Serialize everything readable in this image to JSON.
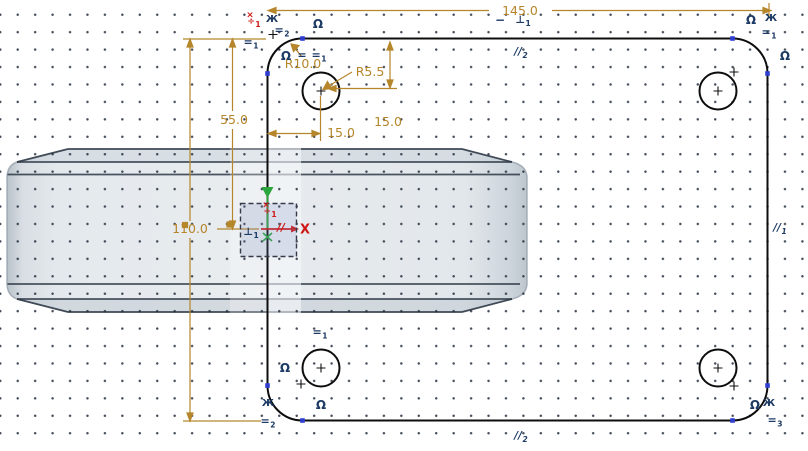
{
  "canvas": {
    "width": 808,
    "height": 451
  },
  "colors": {
    "background": "#ffffff",
    "dim": "#b5862b",
    "con": "#1c3a63",
    "red": "#cf1717",
    "green": "#2aa63c",
    "sketch_line": "#0d0d0d",
    "vertex": "#2e3ed2",
    "part_fill": "#e6eaee",
    "part_edge": "#39424e"
  },
  "grid": {
    "spacing_px": 17.45,
    "style": "dots"
  },
  "sketch": {
    "plate_width": "145.0",
    "plate_height": "110.0",
    "origin_to_top": "55.0",
    "hole_offset_x": "15.0",
    "hole_offset_y": "15.0",
    "hole_radius": "R5.5",
    "corner_radius": "R10.0",
    "x_axis_label": "X"
  },
  "annotations": [
    {
      "n": "dimension-width-label",
      "t": "145.0",
      "x": 520,
      "y": 11,
      "c": "dim",
      "s": 12.5
    },
    {
      "n": "dimension-height-label",
      "t": "110.0",
      "x": 190,
      "y": 229,
      "c": "dim",
      "s": 12.5
    },
    {
      "n": "dimension-half-height-label",
      "t": "55.0",
      "x": 234,
      "y": 120,
      "c": "dim",
      "s": 12.5
    },
    {
      "n": "dimension-hole-x-label",
      "t": "15.0",
      "x": 341,
      "y": 133,
      "c": "dim",
      "s": 12.5
    },
    {
      "n": "dimension-hole-y-label",
      "t": "15.0",
      "x": 388,
      "y": 122,
      "c": "dim",
      "s": 12.5
    },
    {
      "n": "dimension-hole-radius-label",
      "t": "R5.5",
      "x": 370,
      "y": 72,
      "c": "dim",
      "s": 12.5
    },
    {
      "n": "dimension-corner-radius-label",
      "t": "R10.0",
      "x": 303,
      "y": 64,
      "c": "dim",
      "s": 12.5
    },
    {
      "n": "constraint-tangent-icon",
      "t": "Ω",
      "x": 318,
      "y": 24,
      "c": "con",
      "s": 12
    },
    {
      "n": "constraint-tangent-icon",
      "t": "Ω",
      "x": 286,
      "y": 56,
      "c": "con",
      "s": 12
    },
    {
      "n": "constraint-tangent-icon",
      "t": "Ω",
      "x": 751,
      "y": 20,
      "c": "con",
      "s": 12
    },
    {
      "n": "constraint-tangent-icon",
      "t": "Ω",
      "x": 785,
      "y": 56,
      "c": "con",
      "s": 12
    },
    {
      "n": "constraint-tangent-icon",
      "t": "Ω",
      "x": 285,
      "y": 368,
      "c": "con",
      "s": 12
    },
    {
      "n": "constraint-tangent-icon",
      "t": "Ω",
      "x": 321,
      "y": 405,
      "c": "con",
      "s": 12
    },
    {
      "n": "constraint-tangent-icon",
      "t": "Ω",
      "x": 755,
      "y": 405,
      "c": "con",
      "s": 12
    },
    {
      "n": "constraint-symmetry-icon",
      "t": "Ж",
      "x": 272,
      "y": 20,
      "c": "con",
      "s": 10
    },
    {
      "n": "constraint-symmetry-icon",
      "t": "Ж",
      "x": 771,
      "y": 19,
      "c": "con",
      "s": 10
    },
    {
      "n": "constraint-symmetry-icon",
      "t": "Ж",
      "x": 268,
      "y": 404,
      "c": "con",
      "s": 10
    },
    {
      "n": "constraint-symmetry-icon",
      "t": "Ж",
      "x": 769,
      "y": 404,
      "c": "con",
      "s": 10
    },
    {
      "n": "constraint-equal-icon",
      "t": "=",
      "sub": "2",
      "x": 282,
      "y": 31,
      "c": "con",
      "s": 11
    },
    {
      "n": "constraint-equal-icon",
      "t": "=",
      "sub": "1",
      "x": 251,
      "y": 43,
      "c": "con",
      "s": 11
    },
    {
      "n": "constraint-equal-icon",
      "t": "=",
      "x": 302,
      "y": 55,
      "c": "con",
      "s": 11
    },
    {
      "n": "constraint-equal-icon",
      "t": "=",
      "sub": "1",
      "x": 319,
      "y": 56,
      "c": "con",
      "s": 11
    },
    {
      "n": "constraint-equal-icon",
      "t": "=",
      "sub": "1",
      "x": 769,
      "y": 33,
      "c": "con",
      "s": 11
    },
    {
      "n": "constraint-equal-icon",
      "t": "=",
      "sub": "1",
      "x": 320,
      "y": 333,
      "c": "con",
      "s": 11
    },
    {
      "n": "constraint-equal-icon",
      "t": "=",
      "sub": "2",
      "x": 268,
      "y": 422,
      "c": "con",
      "s": 11
    },
    {
      "n": "constraint-equal-icon",
      "t": "=",
      "sub": "3",
      "x": 775,
      "y": 421,
      "c": "con",
      "s": 11
    },
    {
      "n": "constraint-horizontal-icon",
      "t": "−",
      "x": 500,
      "y": 20,
      "c": "con",
      "s": 12
    },
    {
      "n": "constraint-perpendicular-icon",
      "t": "⊥",
      "sub": "1",
      "x": 523,
      "y": 21,
      "c": "con",
      "s": 10.5
    },
    {
      "n": "constraint-perpendicular-icon",
      "t": "⊥",
      "sub": "1",
      "x": 251,
      "y": 233,
      "c": "con",
      "s": 10.5
    },
    {
      "n": "constraint-parallel-icon",
      "t": "//",
      "sub": "2",
      "x": 521,
      "y": 53,
      "c": "con",
      "s": 10.5,
      "i": true
    },
    {
      "n": "constraint-parallel-icon",
      "t": "//",
      "sub": "1",
      "x": 780,
      "y": 229,
      "c": "con",
      "s": 10.5,
      "i": true
    },
    {
      "n": "constraint-parallel-icon",
      "t": "//",
      "sub": "2",
      "x": 521,
      "y": 437,
      "c": "con",
      "s": 10.5,
      "i": true
    },
    {
      "n": "constraint-parallel-x-axis-icon",
      "t": "//",
      "x": 281,
      "y": 228,
      "c": "red",
      "s": 10.5,
      "i": true
    },
    {
      "n": "constraint-symmetric-icon",
      "t": "×",
      "x": 250,
      "y": 16,
      "c": "red",
      "s": 9
    },
    {
      "n": "constraint-symmetric-icon",
      "t": "÷",
      "sub": "1",
      "x": 254,
      "y": 23,
      "c": "red",
      "s": 9
    },
    {
      "n": "constraint-symmetric-icon",
      "t": "×",
      "x": 266,
      "y": 206,
      "c": "red",
      "s": 9
    },
    {
      "n": "constraint-symmetric-icon",
      "t": "÷",
      "sub": "1",
      "x": 270,
      "y": 213,
      "c": "red",
      "s": 9
    },
    {
      "n": "x-axis-label",
      "t": "X",
      "x": 305,
      "y": 230,
      "c": "red",
      "s": 13
    }
  ]
}
